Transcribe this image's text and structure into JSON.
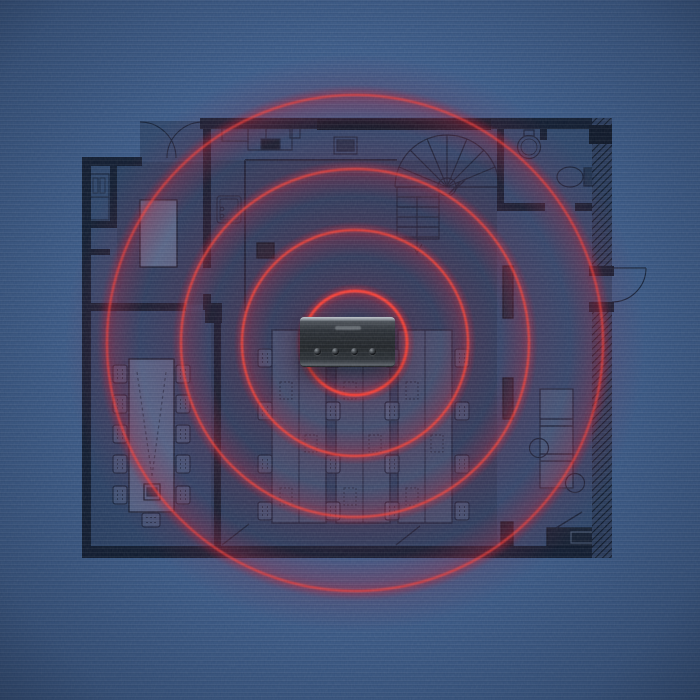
{
  "scene": {
    "title": "office-floor-plan-with-speakerphone-coverage",
    "background_color": "#3c5c8a",
    "accent_color": "#ff4136",
    "glow_color": "#8c1e38",
    "wall_color": "#0f1a2d"
  },
  "device": {
    "name": "conference-speakerphone",
    "logo_mark": "illegible-engraved-brand-logo",
    "button_count": 4,
    "body_color": "#25292e",
    "top_highlight_color": "#bcc4cb"
  },
  "coverage_rings": {
    "center_x": 355,
    "center_y": 343,
    "radii_px": [
      52,
      113,
      174,
      248
    ],
    "ring_count": 4,
    "stroke_color": "#ff4136"
  },
  "floor_plan": {
    "rooms": [
      {
        "name": "entry-vestibule",
        "feature": "double-swing-doors"
      },
      {
        "name": "meeting-room",
        "feature": "small-table"
      },
      {
        "name": "storage-closets",
        "feature": "shelving"
      },
      {
        "name": "conference-room",
        "feature": "long-table-11-chairs"
      },
      {
        "name": "open-office",
        "feature": "three-desk-rows"
      },
      {
        "name": "stairwell",
        "feature": "curved-stair-with-arrow"
      },
      {
        "name": "washroom",
        "feature": "toilet-and-round-basin"
      },
      {
        "name": "kitchenette",
        "feature": "counter-with-two-sinks"
      }
    ],
    "desk_rows": 3,
    "desk_chairs": 16,
    "conference_chairs": 11,
    "doors": [
      "top-left-double-door",
      "right-exterior-door",
      "bottom-left-door",
      "bottom-right-door"
    ]
  }
}
